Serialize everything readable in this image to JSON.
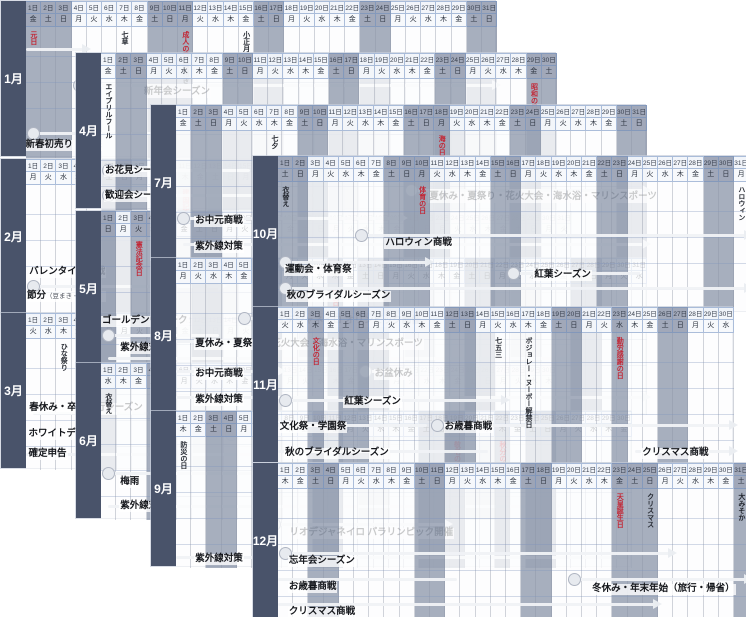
{
  "colors": {
    "holiday_red": "#c22534",
    "label_strip": "#49536a",
    "weekend_fill": "#8b95a9"
  },
  "calendar": {
    "weekday_chars": [
      "日",
      "月",
      "火",
      "水",
      "木",
      "金",
      "土"
    ],
    "date_suffix": "日",
    "months": [
      {
        "name": "1月",
        "x": 0,
        "y": 0,
        "days": 31,
        "start_dow": 5,
        "red_days": [
          {
            "day": 1,
            "label": "元日"
          },
          {
            "day": 11,
            "label": "成人の日"
          }
        ],
        "observances": [
          {
            "day": 7,
            "label": "七草"
          },
          {
            "day": 11,
            "label": "鏡開き",
            "dy": 36
          },
          {
            "day": 15,
            "label": "小正月"
          }
        ],
        "extra_shaded_days": [],
        "bars": [
          {
            "y": 48,
            "s": 0,
            "e": 4,
            "arrow": true
          },
          {
            "y": 84,
            "s": 4,
            "e": 31,
            "circle": true,
            "arrow": true,
            "label": "新年会シーズン",
            "ld": 8.7,
            "ldy": 2
          },
          {
            "y": 132,
            "s": 1,
            "e": 10,
            "circle": true,
            "label": "新春初売り・福袋",
            "ld": 0.9,
            "ldy": 7
          }
        ]
      },
      {
        "name": "2月",
        "x": 0,
        "y": 158,
        "days": 29,
        "start_dow": 1,
        "red_days": [
          {
            "day": 11,
            "label": "建国記念の日"
          }
        ],
        "observances": [],
        "extra_shaded_days": [],
        "bars": [
          {
            "y": 127,
            "s": 1,
            "e": 13,
            "circle": true,
            "arrow": true,
            "label": "バレンタイン商戦",
            "ld": 1.15,
            "ldy": -19
          },
          {
            "y": 140,
            "line": false,
            "label": "節分",
            "sub": "（豆まき・恵方巻）",
            "ld": 1.0,
            "ldy": -8
          }
        ]
      },
      {
        "name": "3月",
        "x": 0,
        "y": 312,
        "days": 31,
        "start_dow": 2,
        "red_days": [
          {
            "day": 20,
            "label": "春分の日"
          }
        ],
        "observances": [
          {
            "day": 3,
            "label": "ひな祭り"
          }
        ],
        "extra_shaded_days": [
          21
        ],
        "bars": [
          {
            "y": 100,
            "s": 1,
            "e": 31,
            "arrow": true,
            "label": "春休み・卒業旅行シーズン",
            "ld": 1.15,
            "ldy": -10
          },
          {
            "y": 121,
            "s": 14,
            "e": 15,
            "circle": true,
            "label": "ホワイトデー",
            "ld": 1.1,
            "ldy": -5
          },
          {
            "y": 141,
            "s": 0,
            "e": 15,
            "label": "確定申告",
            "ld": 1.1,
            "ldy": -5
          }
        ]
      },
      {
        "name": "4月",
        "x": 75,
        "y": 52,
        "days": 30,
        "start_dow": 5,
        "red_days": [
          {
            "day": 29,
            "label": "昭和の日"
          }
        ],
        "observances": [
          {
            "day": 1,
            "label": "エイプリルフール"
          }
        ],
        "extra_shaded_days": [],
        "bars": [
          {
            "y": 117,
            "s": 1,
            "e": 10,
            "circle": true,
            "label": "お花見シーズン",
            "ld": 1.2,
            "ldy": -4
          },
          {
            "y": 142,
            "s": 1,
            "e": 15,
            "circle": true,
            "label": "歓迎会シーズン",
            "ld": 1.2,
            "ldy": -4
          }
        ]
      },
      {
        "name": "5月",
        "x": 75,
        "y": 210,
        "days": 31,
        "start_dow": 0,
        "red_days": [
          {
            "day": 3,
            "label": "憲法記念日"
          },
          {
            "day": 4,
            "label": "みどりの日"
          },
          {
            "day": 5,
            "label": "こどもの日"
          }
        ],
        "observances": [],
        "extra_shaded_days": [],
        "bars": [
          {
            "y": 124,
            "s": 1,
            "e": 8,
            "circle": true,
            "label": "ゴールデンウイーク",
            "ld": 1.0,
            "ldy": -19
          },
          {
            "y": 147,
            "s": 1,
            "e": 31,
            "arrow": true,
            "label": "紫外線対策",
            "ld": 2.2,
            "ldy": -15
          }
        ]
      },
      {
        "name": "6月",
        "x": 75,
        "y": 362,
        "days": 30,
        "start_dow": 3,
        "red_days": [],
        "observances": [
          {
            "day": 1,
            "label": "衣替え"
          }
        ],
        "extra_shaded_days": [],
        "bars": [
          {
            "y": 110,
            "s": 1,
            "e": 30,
            "circle": true,
            "arrow": true,
            "label": "梅雨",
            "ld": 2.2,
            "ldy": 4
          },
          {
            "y": 143,
            "s": 1,
            "e": 30,
            "arrow": true,
            "label": "紫外線対策",
            "ld": 2.2,
            "ldy": -5
          }
        ]
      },
      {
        "name": "7月",
        "x": 150,
        "y": 104,
        "days": 31,
        "start_dow": 5,
        "red_days": [
          {
            "day": 18,
            "label": "海の日"
          }
        ],
        "observances": [
          {
            "day": 7,
            "label": "七夕"
          }
        ],
        "extra_shaded_days": [],
        "bars": [
          {
            "y": 85,
            "s": 16,
            "e": 31,
            "circle": true,
            "arrow": true,
            "label": "夏休み・夏祭り・花火大会・海水浴・マリンスポーツ",
            "ld": 17.6,
            "ldy": 2
          },
          {
            "y": 113,
            "s": 1,
            "e": 15,
            "circle": true,
            "arrow": true,
            "label": "お中元商戦",
            "ld": 2.2,
            "ldy": -2
          },
          {
            "y": 139,
            "s": 1,
            "e": 31,
            "arrow": true,
            "label": "紫外線対策",
            "ld": 2.2,
            "ldy": -2
          }
        ]
      },
      {
        "name": "8月",
        "x": 150,
        "y": 257,
        "days": 31,
        "start_dow": 1,
        "red_days": [
          {
            "day": 11,
            "label": "山の日"
          }
        ],
        "observances": [],
        "extra_shaded_days": [],
        "bars": [
          {
            "y": 60,
            "s": 5,
            "e": 21,
            "circle": true,
            "label": "リオデジャネイロ オリンピック開催",
            "ld": 6.9,
            "ldy": -2
          },
          {
            "y": 83,
            "s": 0,
            "e": 16,
            "label": "夏休み・夏祭り・花火大会・海水浴・マリンスポーツ",
            "ld": 2.2,
            "ldy": -2
          },
          {
            "y": 113,
            "s": 0,
            "e": 7,
            "arrow": true,
            "label": "お中元商戦",
            "ld": 2.2,
            "ldy": -2
          },
          {
            "y": 113,
            "s": 13,
            "e": 16,
            "circle": true,
            "label": "お盆休み",
            "ld": 14.0,
            "ldy": -2
          },
          {
            "y": 139,
            "s": 0,
            "e": 31,
            "arrow": true,
            "label": "紫外線対策",
            "ld": 2.2,
            "ldy": -2
          }
        ]
      },
      {
        "name": "9月",
        "x": 150,
        "y": 410,
        "days": 30,
        "start_dow": 4,
        "red_days": [
          {
            "day": 19,
            "label": "敬老の日"
          },
          {
            "day": 22,
            "label": "秋分の日"
          }
        ],
        "observances": [
          {
            "day": 1,
            "label": "防災の日"
          }
        ],
        "extra_shaded_days": [],
        "bars": [
          {
            "y": 113,
            "s": 7,
            "e": 18,
            "circle": true,
            "arrow": true,
            "label": "リオデジャネイロ パラリンピック開催",
            "ld": 8.4,
            "ldy": 4
          },
          {
            "y": 146,
            "s": 0,
            "e": 30,
            "label": "紫外線対策",
            "ld": 2.2,
            "ldy": -3
          }
        ]
      },
      {
        "name": "10月",
        "x": 252,
        "y": 155,
        "days": 31,
        "start_dow": 6,
        "red_days": [
          {
            "day": 10,
            "label": "体育の日"
          }
        ],
        "observances": [
          {
            "day": 1,
            "label": "衣替え"
          },
          {
            "day": 31,
            "label": "ハロウィン"
          }
        ],
        "extra_shaded_days": [],
        "bars": [
          {
            "y": 79,
            "s": 6,
            "e": 31,
            "circle": true,
            "arrow": true,
            "label": "ハロウィン商戦",
            "ld": 8.0,
            "ldy": 3
          },
          {
            "y": 106,
            "s": 1,
            "e": 10,
            "circle": true,
            "arrow": true,
            "label": "運動会・体育祭",
            "ld": 1.4,
            "ldy": 3
          },
          {
            "y": 117,
            "s": 16,
            "e": 24,
            "circle": true,
            "label": "紅葉シーズン",
            "ld": 17.8,
            "ldy": -3
          },
          {
            "y": 132,
            "s": 1,
            "e": 31,
            "circle": true,
            "arrow": true,
            "label": "秋のブライダルシーズン",
            "ld": 1.5,
            "ldy": 3
          }
        ]
      },
      {
        "name": "11月",
        "x": 252,
        "y": 306,
        "days": 30,
        "start_dow": 2,
        "red_days": [
          {
            "day": 3,
            "label": "文化の日"
          },
          {
            "day": 23,
            "label": "勤労感謝の日"
          }
        ],
        "observances": [
          {
            "day": 15,
            "label": "七五三"
          },
          {
            "day": 17,
            "label": "ボジョレー・ヌーボー解禁日"
          }
        ],
        "extra_shaded_days": [],
        "bars": [
          {
            "y": 93,
            "s": 1,
            "e": 15,
            "circle": true,
            "arrow": true,
            "label": "紅葉シーズン",
            "ld": 5.3,
            "ldy": -3
          },
          {
            "y": 118,
            "s": 0,
            "e": 10,
            "label": "文化祭・学園祭",
            "ld": 1.05,
            "ldy": -3
          },
          {
            "y": 118,
            "s": 11,
            "e": 30,
            "circle": true,
            "arrow": true,
            "label": "お歳暮商戦",
            "ld": 11.9,
            "ldy": -3
          },
          {
            "y": 144,
            "s": 0,
            "e": 14,
            "label": "秋のブライダルシーズン",
            "ld": 1.4,
            "ldy": -3
          },
          {
            "y": 144,
            "s": 24,
            "e": 30,
            "arrow": true,
            "label": "クリスマス商戦",
            "ld": 24.9,
            "ldy": -3
          }
        ]
      },
      {
        "name": "12月",
        "x": 252,
        "y": 462,
        "days": 31,
        "start_dow": 4,
        "red_days": [
          {
            "day": 23,
            "label": "天皇誕生日"
          }
        ],
        "observances": [
          {
            "day": 25,
            "label": "クリスマス"
          },
          {
            "day": 31,
            "label": "大みそか"
          }
        ],
        "extra_shaded_days": [],
        "bars": [
          {
            "y": 90,
            "s": 1,
            "e": 26,
            "circle": true,
            "arrow": true,
            "label": "忘年会シーズン",
            "ld": 1.65,
            "ldy": 3
          },
          {
            "y": 116,
            "s": 0,
            "e": 12,
            "label": "お歳暮商戦",
            "ld": 1.65,
            "ldy": 3
          },
          {
            "y": 116,
            "s": 20,
            "e": 31,
            "circle": true,
            "arrow": true,
            "label": "冬休み・年末年始（旅行・帰省）",
            "ld": 21.6,
            "ldy": 5
          },
          {
            "y": 141,
            "s": 0,
            "e": 25,
            "arrow": true,
            "label": "クリスマス商戦",
            "ld": 1.65,
            "ldy": 3
          }
        ]
      }
    ]
  }
}
